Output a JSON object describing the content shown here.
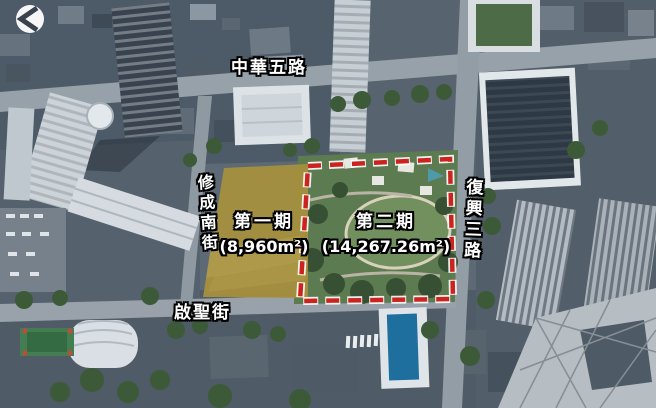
{
  "watermark": {
    "icon": "back-chevron-circle-icon"
  },
  "roads": {
    "top": {
      "label": "中華五路"
    },
    "left": {
      "label": "修成南街"
    },
    "right": {
      "label": "復興三路"
    },
    "bottom": {
      "label": "啟聖街"
    }
  },
  "zones": {
    "phase1": {
      "label": "第一期",
      "area": "(8,960m²)",
      "fill_color": "#a6903d"
    },
    "phase2": {
      "label": "第二期",
      "area": "(14,267.26m²)",
      "border_color": "#cb241f",
      "border_style": "dashed"
    }
  }
}
